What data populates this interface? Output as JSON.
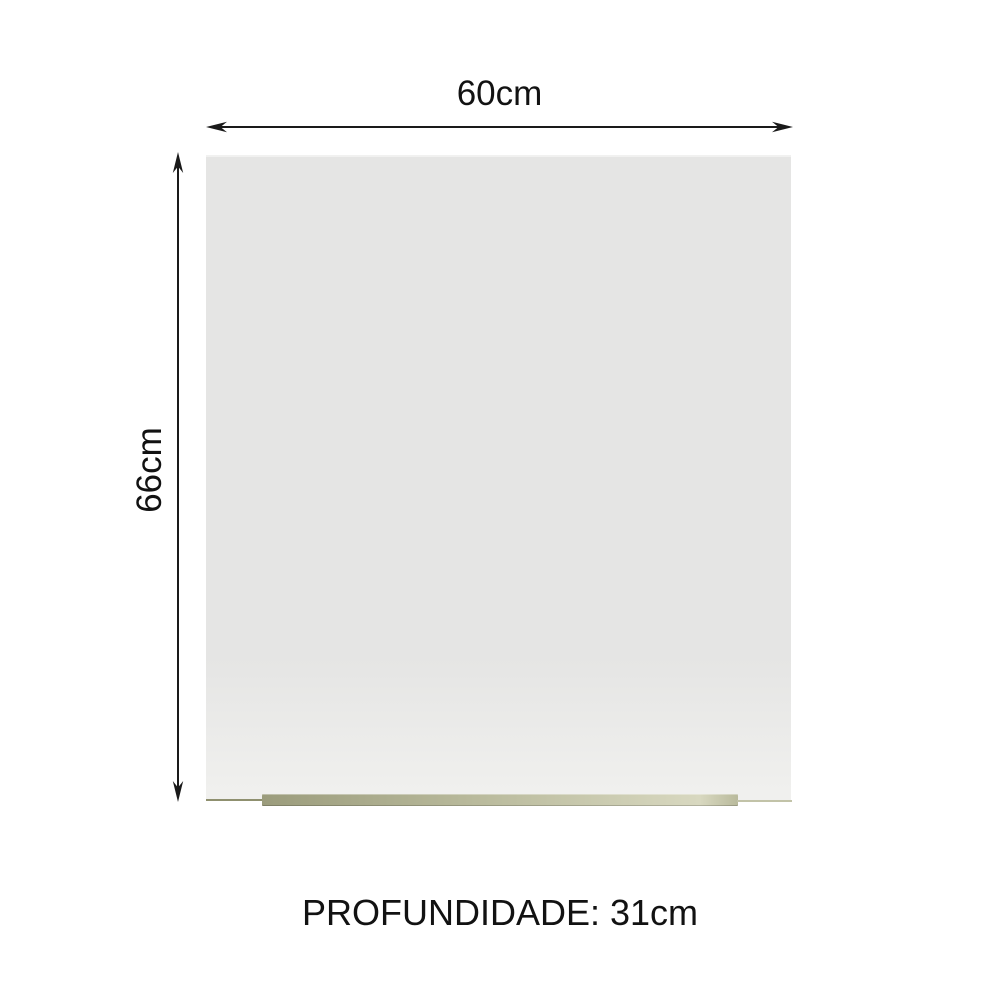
{
  "dimensions": {
    "width": {
      "label": "60cm"
    },
    "height": {
      "label": "66cm"
    },
    "depth": {
      "label": "PROFUNDIDADE: 31cm"
    }
  },
  "icons": {
    "width_arrow": "double-headed-horizontal-arrow",
    "height_arrow": "double-headed-vertical-arrow"
  },
  "colors": {
    "background": "#ffffff",
    "panel": "#e5e5e4",
    "panel_bottom": "#f0f0ee",
    "handle_dark": "#9b9c7c",
    "handle_mid": "#b9ba9c",
    "handle_light": "#d8d8c0",
    "handle_edge": "#8f906f",
    "handle_edge_light": "#c2c3a8",
    "arrow": "#1a1a1a",
    "text": "#121212"
  }
}
